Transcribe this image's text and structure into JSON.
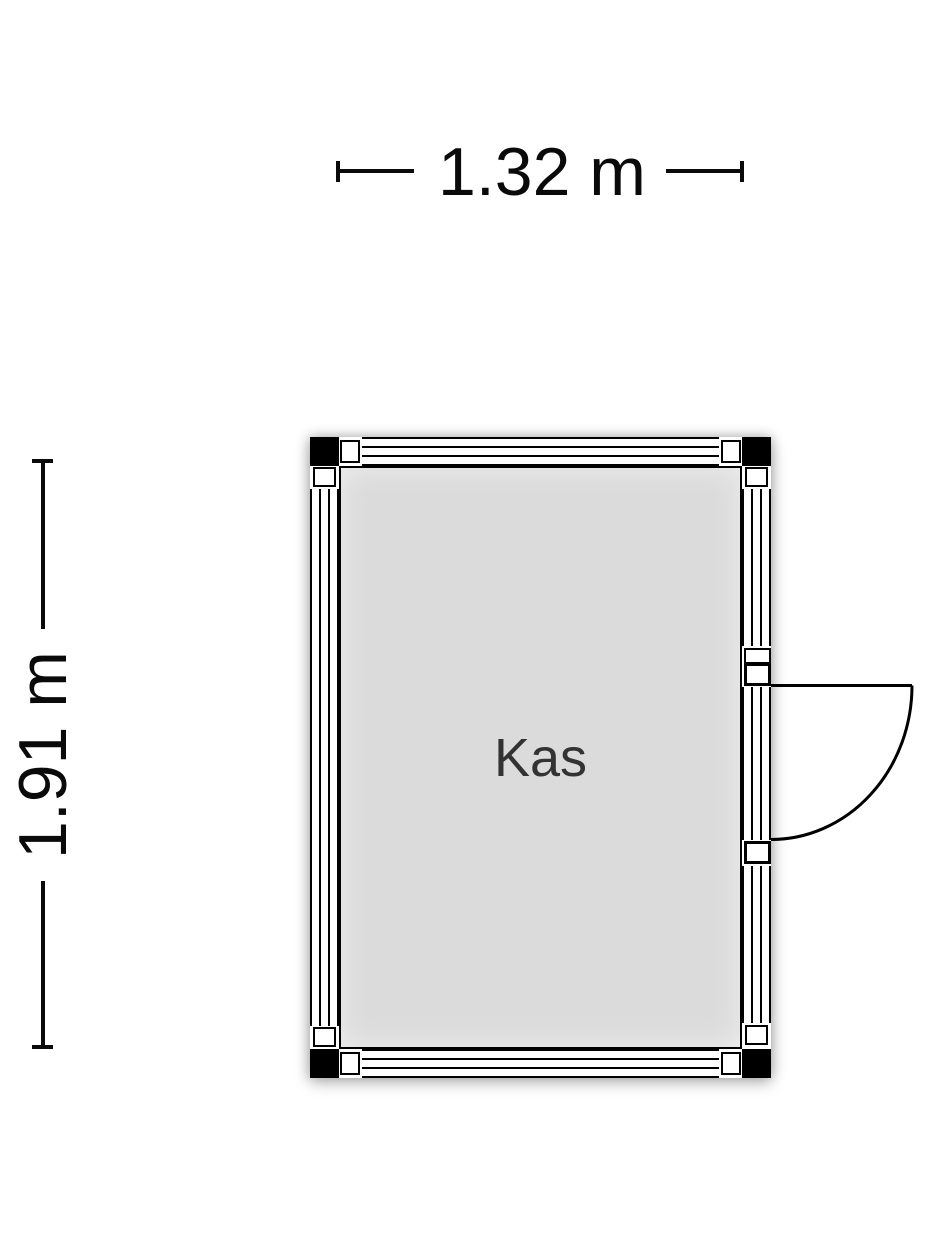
{
  "floor_plan": {
    "room": {
      "label": "Kas"
    },
    "dimensions": {
      "width": "1.32 m",
      "height": "1.91 m"
    },
    "colors": {
      "line": "#000000",
      "room_fill": "#dbdbdb",
      "corner_post": "#000000",
      "room_label_text": "#333333",
      "dimension_text": "#0a0a0a",
      "background": "#ffffff"
    }
  }
}
